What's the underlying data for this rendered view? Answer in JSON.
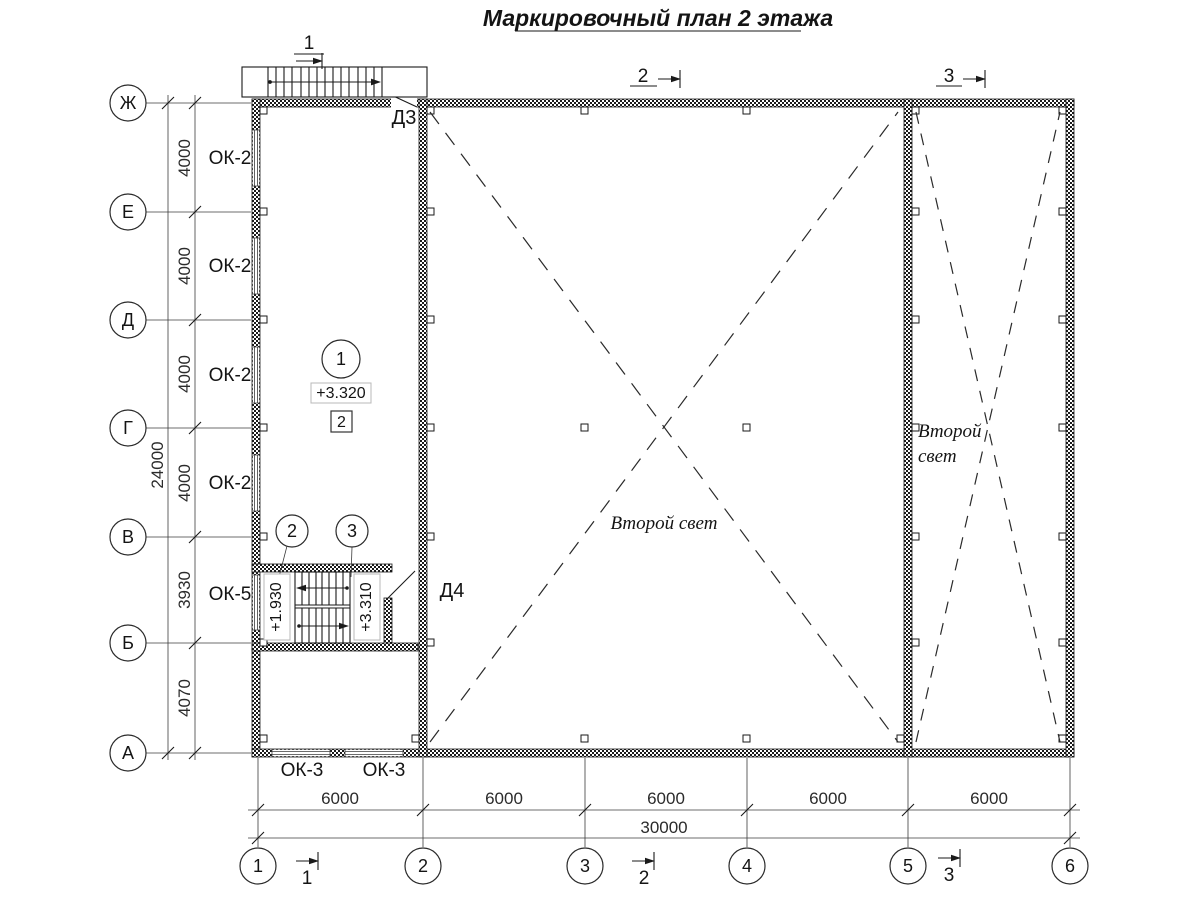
{
  "title": "Маркировочный план 2 этажа",
  "axes": {
    "rows": [
      "Ж",
      "Е",
      "Д",
      "Г",
      "В",
      "Б",
      "А"
    ],
    "cols": [
      "1",
      "2",
      "3",
      "4",
      "5",
      "6"
    ]
  },
  "dimensions": {
    "left_segments": [
      "4000",
      "4000",
      "4000",
      "4000",
      "3930",
      "4070"
    ],
    "left_total": "24000",
    "bottom_segments": [
      "6000",
      "6000",
      "6000",
      "6000",
      "6000"
    ],
    "bottom_total": "30000"
  },
  "windows": {
    "ok2": [
      "ОК-2",
      "ОК-2",
      "ОК-2",
      "ОК-2"
    ],
    "ok5": "ОК-5",
    "ok3": [
      "ОК-3",
      "ОК-3"
    ]
  },
  "doors": {
    "d3": "Д3",
    "d4": "Д4"
  },
  "marks": {
    "room_number": "1",
    "room_elevation": "+3.320",
    "floor_type": "2",
    "stair_mark_2": "2",
    "stair_mark_3": "3",
    "stair_elevation_mid": "+1.930",
    "stair_elevation_top": "+3.310"
  },
  "sections": {
    "s1": "1",
    "s2": "2",
    "s3": "3"
  },
  "labels": {
    "second_light": "Второй свет",
    "second_light_l1": "Второй",
    "second_light_l2": "свет"
  },
  "colors": {
    "line": "#1a1a1a",
    "background": "#ffffff"
  }
}
